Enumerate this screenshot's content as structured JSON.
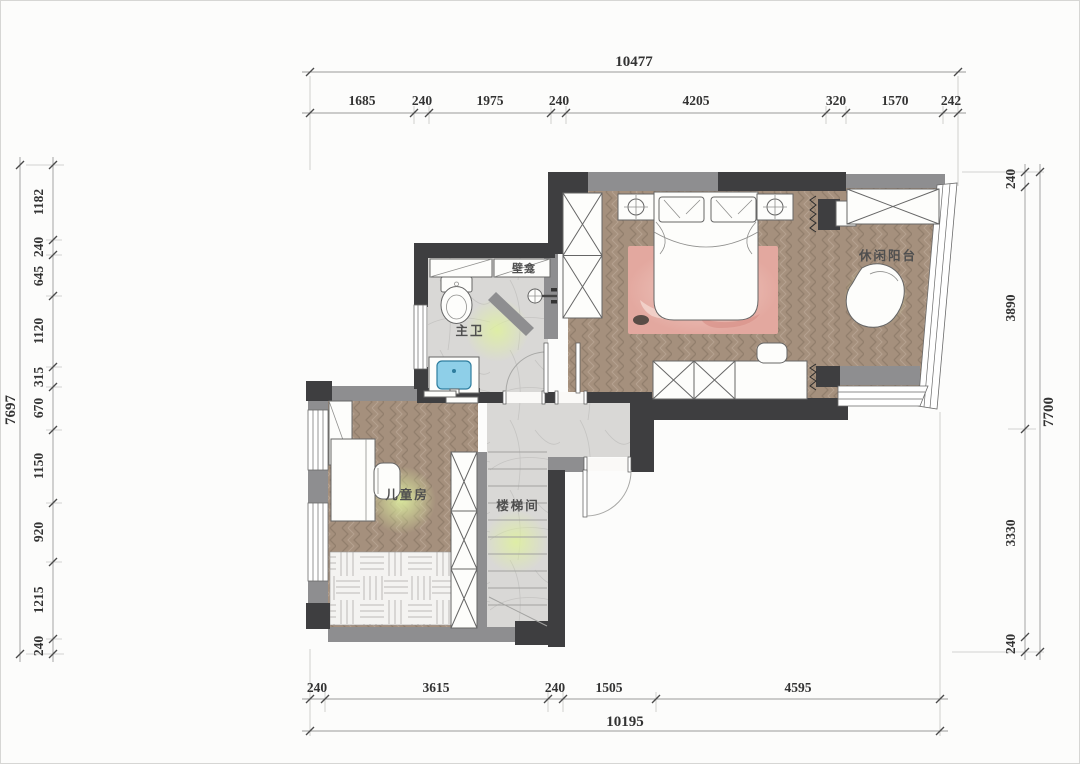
{
  "rooms": {
    "master_bath": "主卫",
    "niche": "壁龛",
    "leisure_balcony": "休闲阳台",
    "kids_room": "儿童房",
    "stairwell": "楼梯间"
  },
  "dims": {
    "top": {
      "total": "10477",
      "segments": [
        "1685",
        "240",
        "1975",
        "240",
        "4205",
        "320",
        "1570",
        "242"
      ]
    },
    "bottom": {
      "total": "10195",
      "segments": [
        "240",
        "3615",
        "240",
        "1505",
        "4595"
      ]
    },
    "left": {
      "total": "7697",
      "segments": [
        "1182",
        "240",
        "645",
        "1120",
        "315",
        "670",
        "1150",
        "920",
        "1215",
        "240"
      ]
    },
    "right": {
      "total": "7700",
      "segments": [
        "240",
        "3890",
        "3330",
        "240"
      ]
    }
  },
  "colors": {
    "paper": "#fcfcfb",
    "wall-dark": "#3e3e40",
    "wall-gray": "#8e8e90",
    "wood": "#a5907d",
    "wood-line": "#927f6d",
    "wood-light": "#b8a593",
    "marble": "#d9d8d6",
    "marble-line": "#c5c4c2",
    "tatami-bg": "#f4f3f1",
    "tatami-line": "#bdbab6",
    "rug": "#e3a89f",
    "rug-light": "#f0cdc5",
    "sink": "#8ecfe8",
    "glow": "#dff0a0",
    "fixture-fill": "#fdfdfb",
    "fixture-stroke": "#666666",
    "dim-line": "#9a9a9a",
    "dim-tick": "#4a4a4a",
    "dim-text": "#333333",
    "label-text": "#4f4f4f",
    "window-stroke": "#6a6a6a"
  }
}
